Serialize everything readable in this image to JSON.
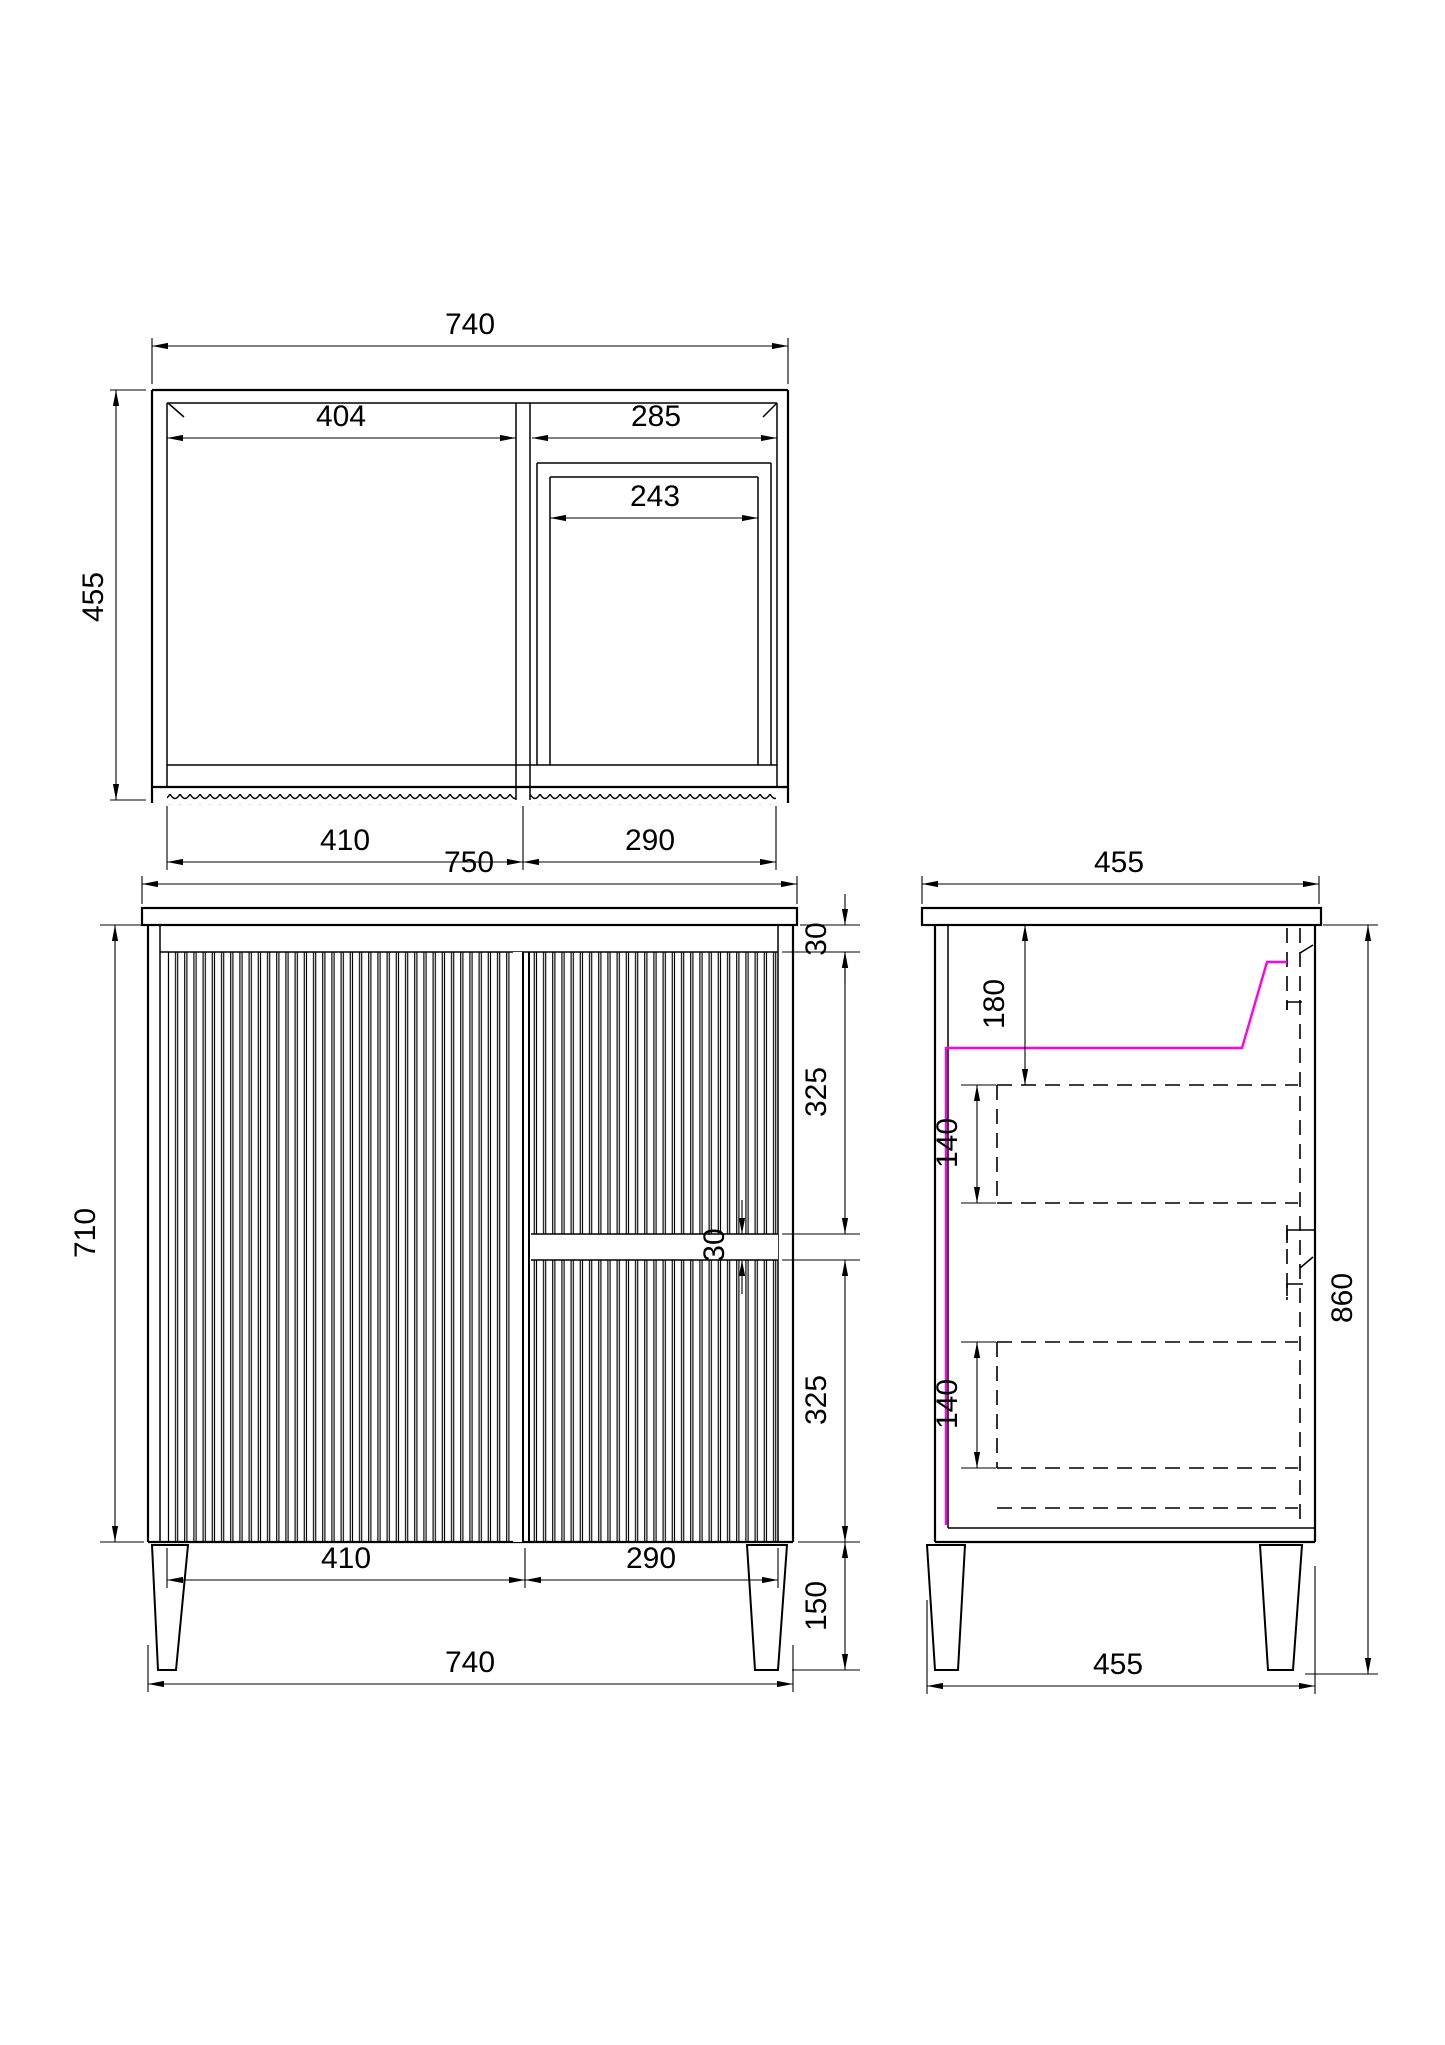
{
  "meta": {
    "drawing_type": "vanity cabinet technical drawing",
    "line_color": "#000000",
    "accent_color": "#ff00e8",
    "background": "#ffffff"
  },
  "views": {
    "top": {
      "overall_width": "740",
      "overall_depth": "455",
      "left_internal_width": "404",
      "right_internal_width": "285",
      "basin_cutout_width": "243",
      "left_door_width": "410",
      "right_door_width": "290"
    },
    "front": {
      "benchtop_width": "750",
      "body_height": "710",
      "top_rail_height": "30",
      "upper_drawer_height": "325",
      "groove_height": "30",
      "lower_drawer_height": "325",
      "left_door_width": "410",
      "right_door_width": "290",
      "leg_height": "150",
      "body_width": "740"
    },
    "side": {
      "benchtop_depth": "455",
      "basin_depth": "180",
      "upper_drawer_front": "140",
      "lower_drawer_front": "140",
      "overall_height": "860",
      "base_depth": "455"
    }
  }
}
